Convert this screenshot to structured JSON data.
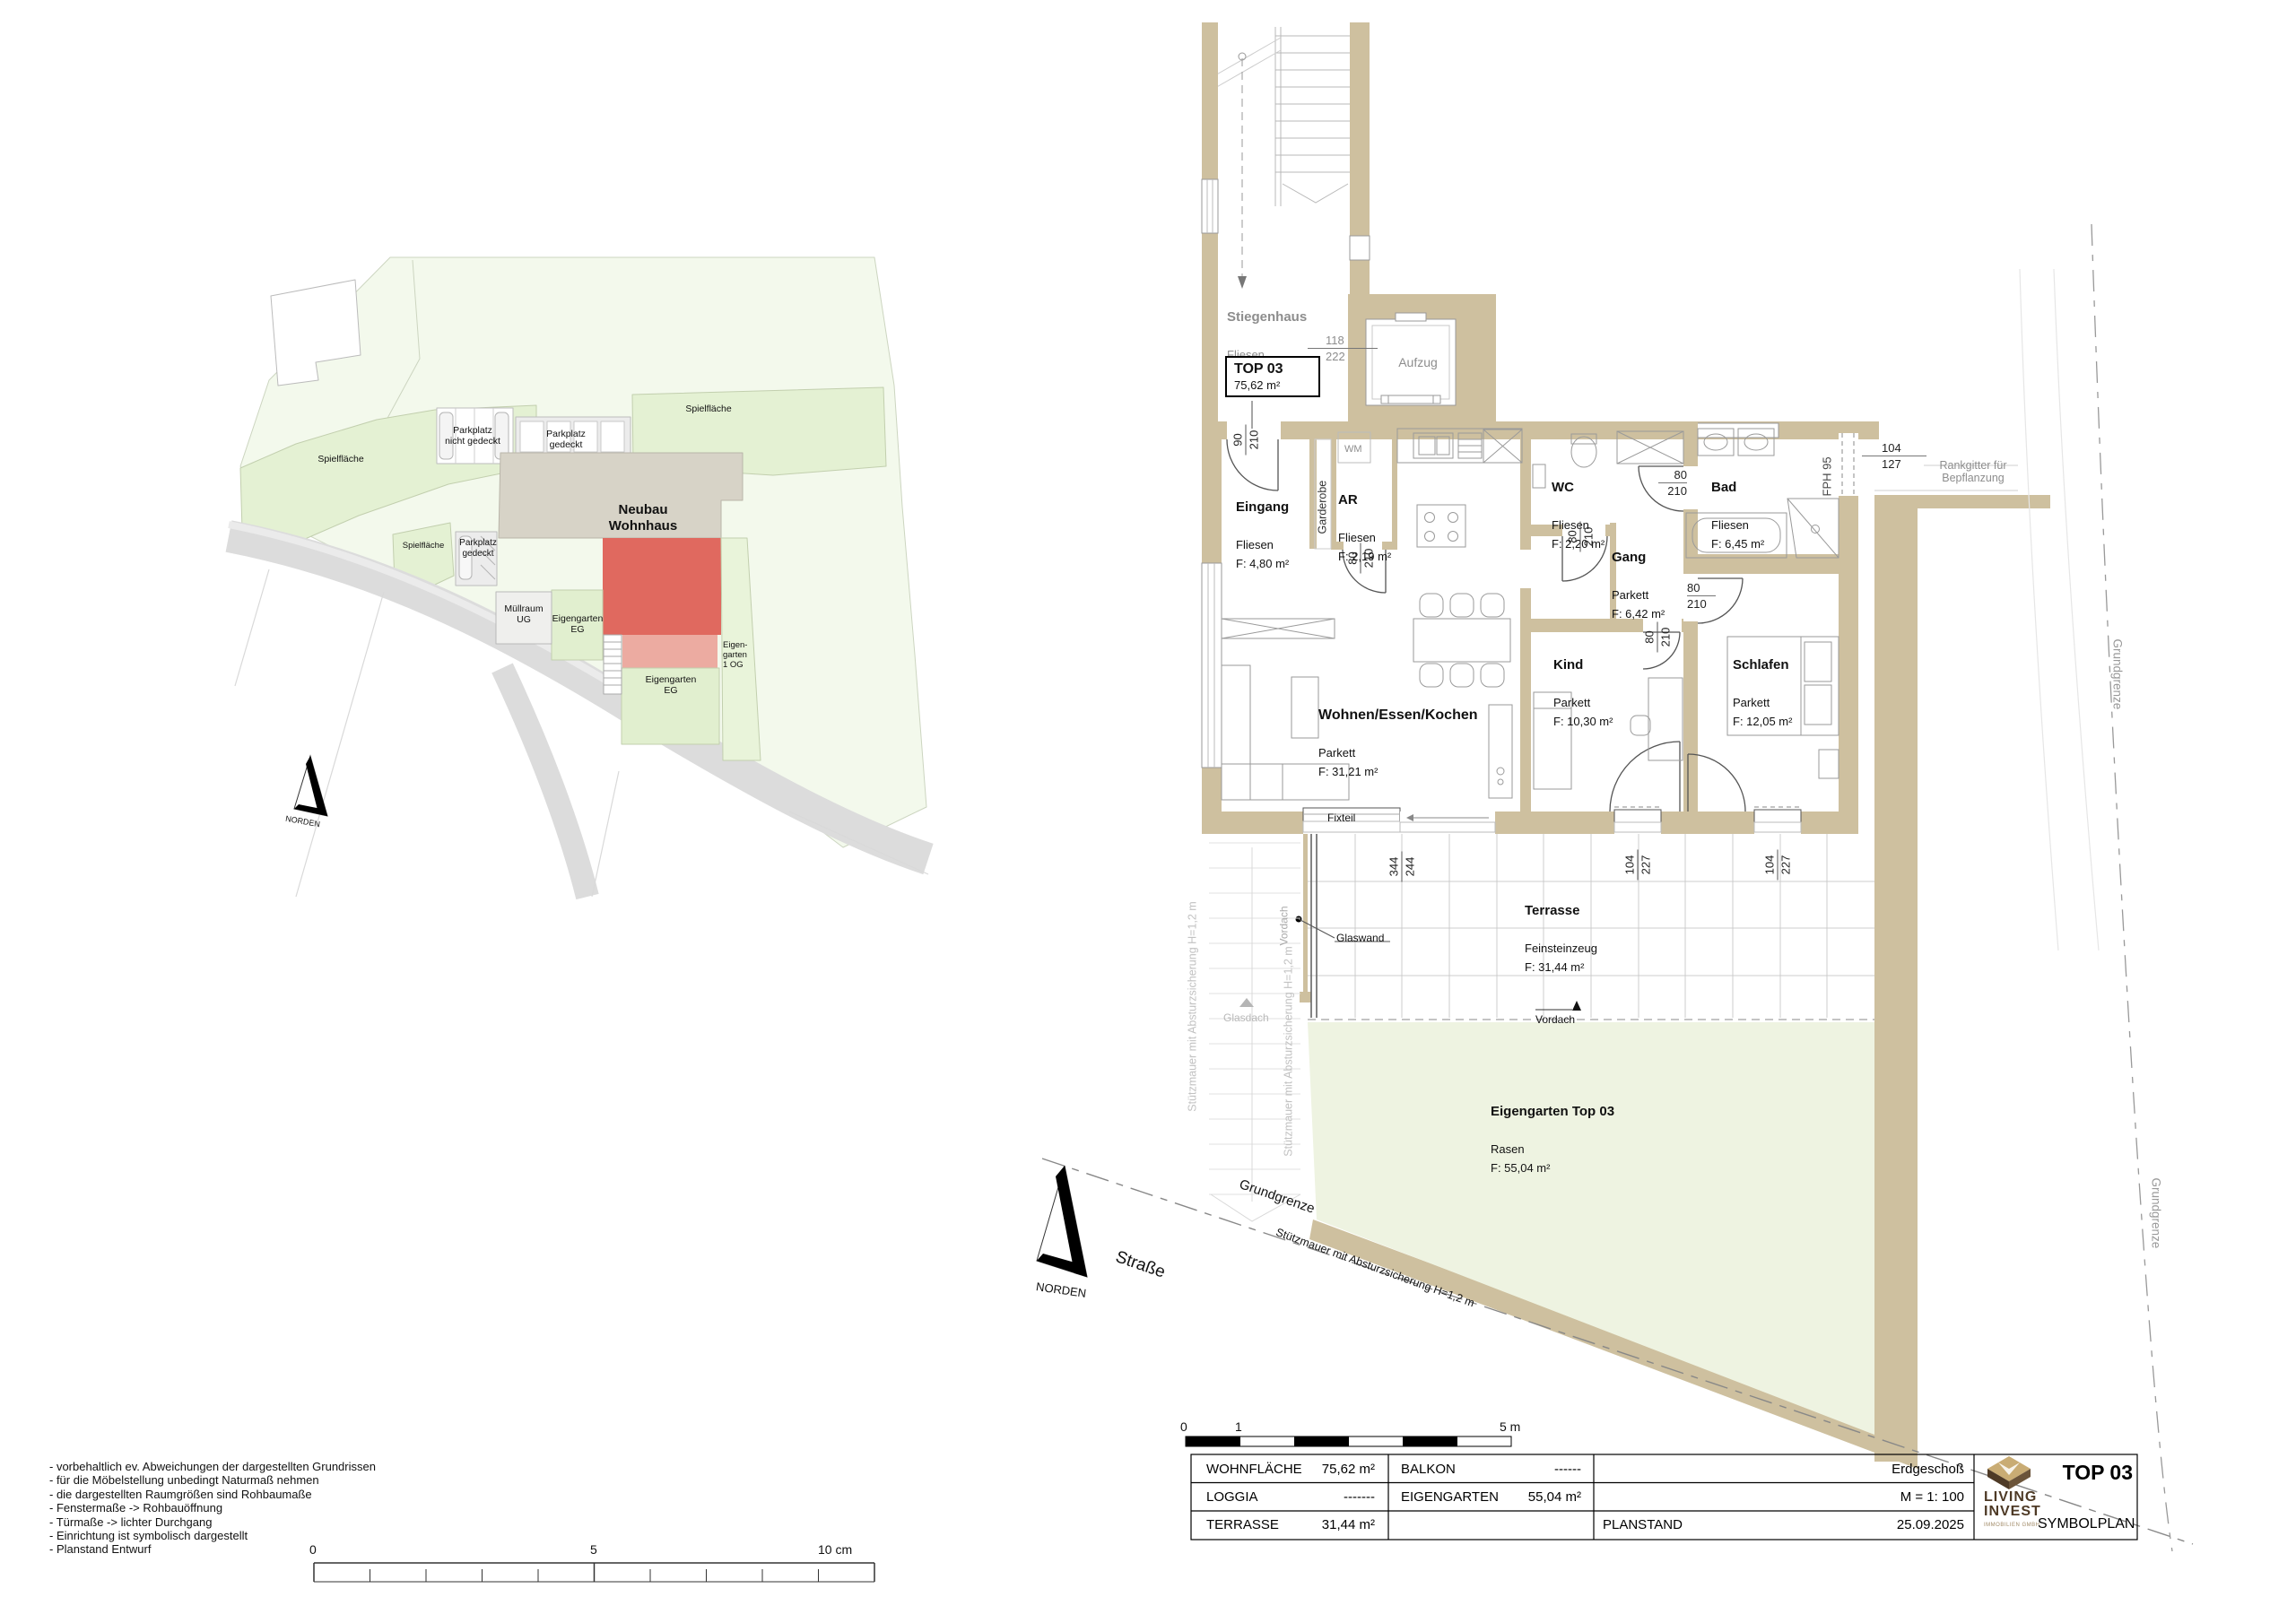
{
  "site_plan": {
    "north_label": "NORDEN",
    "building_label": "Neubau\nWohnhaus",
    "labels": {
      "spielflaeche_1": "Spielfläche",
      "spielflaeche_2": "Spielfläche",
      "spielflaeche_3": "Spielfläche",
      "parkplatz_nicht_gedeckt": "Parkplatz\nnicht gedeckt",
      "parkplatz_gedeckt_1": "Parkplatz\ngedeckt",
      "parkplatz_gedeckt_2": "Parkplatz\ngedeckt",
      "muellraum": "Müllraum\nUG",
      "eigengarten_eg_1": "Eigengarten\nEG",
      "eigengarten_eg_2": "Eigengarten\nEG",
      "eigengarten_og": "Eigen-\ngarten\n1 OG"
    }
  },
  "floor_plan": {
    "north_label": "NORDEN",
    "top_box": {
      "title": "TOP 03",
      "area": "75,62 m²"
    },
    "rooms": {
      "stiegenhaus": {
        "name": "Stiegenhaus",
        "floor": "Fliesen",
        "area": "F: 11,95 m²"
      },
      "aufzug": {
        "name": "Aufzug"
      },
      "eingang": {
        "name": "Eingang",
        "floor": "Fliesen",
        "area": "F: 4,80 m²"
      },
      "ar": {
        "name": "AR",
        "floor": "Fliesen",
        "area": "F: 2,19 m²"
      },
      "wc": {
        "name": "WC",
        "floor": "Fliesen",
        "area": "F: 2,20 m²"
      },
      "gang": {
        "name": "Gang",
        "floor": "Parkett",
        "area": "F: 6,42 m²"
      },
      "bad": {
        "name": "Bad",
        "floor": "Fliesen",
        "area": "F: 6,45 m²"
      },
      "kind": {
        "name": "Kind",
        "floor": "Parkett",
        "area": "F: 10,30 m²"
      },
      "schlafen": {
        "name": "Schlafen",
        "floor": "Parkett",
        "area": "F: 12,05 m²"
      },
      "wohnen": {
        "name": "Wohnen/Essen/Kochen",
        "floor": "Parkett",
        "area": "F: 31,21 m²"
      },
      "terrasse": {
        "name": "Terrasse",
        "floor": "Feinsteinzeug",
        "area": "F: 31,44 m²"
      },
      "eigengarten": {
        "name": "Eigengarten Top 03",
        "floor": "Rasen",
        "area": "F: 55,04 m²"
      }
    },
    "dims": {
      "eingang_door": {
        "w": "90",
        "h": "210"
      },
      "elevator": {
        "w": "118",
        "h": "222"
      },
      "ar_door": {
        "w": "80",
        "h": "210"
      },
      "wc_door": {
        "w": "80",
        "h": "210"
      },
      "bad_door": {
        "w": "80",
        "h": "210"
      },
      "schlafen_door": {
        "w": "80",
        "h": "210"
      },
      "kind_door": {
        "w": "80",
        "h": "210"
      },
      "bad_window": {
        "w": "104",
        "h": "127"
      },
      "terrace_door": {
        "w": "344",
        "h": "244"
      },
      "kind_window": {
        "w": "104",
        "h": "227"
      },
      "schlafen_window": {
        "w": "104",
        "h": "227"
      }
    },
    "annotations": {
      "wm": "WM",
      "garderobe": "Garderobe",
      "fph95": "FPH 95",
      "fixteil": "Fixteil",
      "glaswand": "Glaswand",
      "vordach_bottom": "Vordach",
      "vordach_left": "Vordach",
      "glasdach": "Glasdach",
      "rankgitter": "Rankgitter für\nBepflanzung",
      "stuetzmauer_v1": "Stützmauer mit Absturzsicherung H=1,2 m",
      "stuetzmauer_v2": "Stützmauer mit Absturzsicherung H=1,2 m",
      "stuetzmauer_slope": "Stützmauer mit Absturzsicherung H=1,2 m",
      "grundgrenze_right_1": "Grundgrenze",
      "grundgrenze_right_2": "Grundgrenze",
      "grundgrenze_bottom": "Grundgrenze",
      "strasse": "Straße"
    }
  },
  "notes": [
    "- vorbehaltlich ev. Abweichungen der dargestellten Grundrissen",
    "- für die Möbelstellung unbedingt Naturmaß nehmen",
    "- die dargestellten Raumgrößen sind Rohbaumaße",
    "- Fenstermaße -> Rohbauöffnung",
    "- Türmaße -> lichter Durchgang",
    "- Einrichtung ist symbolisch dargestellt",
    "- Planstand Entwurf"
  ],
  "scale_bar_m": {
    "t0": "0",
    "t1": "1",
    "t5": "5 m"
  },
  "scale_bar_cm": {
    "t0": "0",
    "t5": "5",
    "t10": "10 cm"
  },
  "title_block": {
    "cells": {
      "wohnflaeche_label": "WOHNFLÄCHE",
      "wohnflaeche_value": "75,62 m²",
      "balkon_label": "BALKON",
      "balkon_value": "------",
      "loggia_label": "LOGGIA",
      "loggia_value": "-------",
      "eigengarten_label": "EIGENGARTEN",
      "eigengarten_value": "55,04 m²",
      "terrasse_label": "TERRASSE",
      "terrasse_value": "31,44 m²",
      "floor": "Erdgeschoß",
      "scale": "M = 1: 100",
      "planstand_label": "PLANSTAND",
      "planstand_value": "25.09.2025"
    },
    "logo": {
      "line1": "LIVING",
      "line2": "INVEST",
      "line3": "IMMOBILIEN GMBH"
    },
    "unit": "TOP 03",
    "plan_type": "SYMBOLPLAN"
  },
  "colors": {
    "wall": "#cec09f",
    "unit_red": "#e0695f",
    "unit_red_light": "#ecaba1",
    "garden_green": "#eef3e1",
    "site_green": "#e4f1d3",
    "logo_brown": "#4e3a26"
  }
}
